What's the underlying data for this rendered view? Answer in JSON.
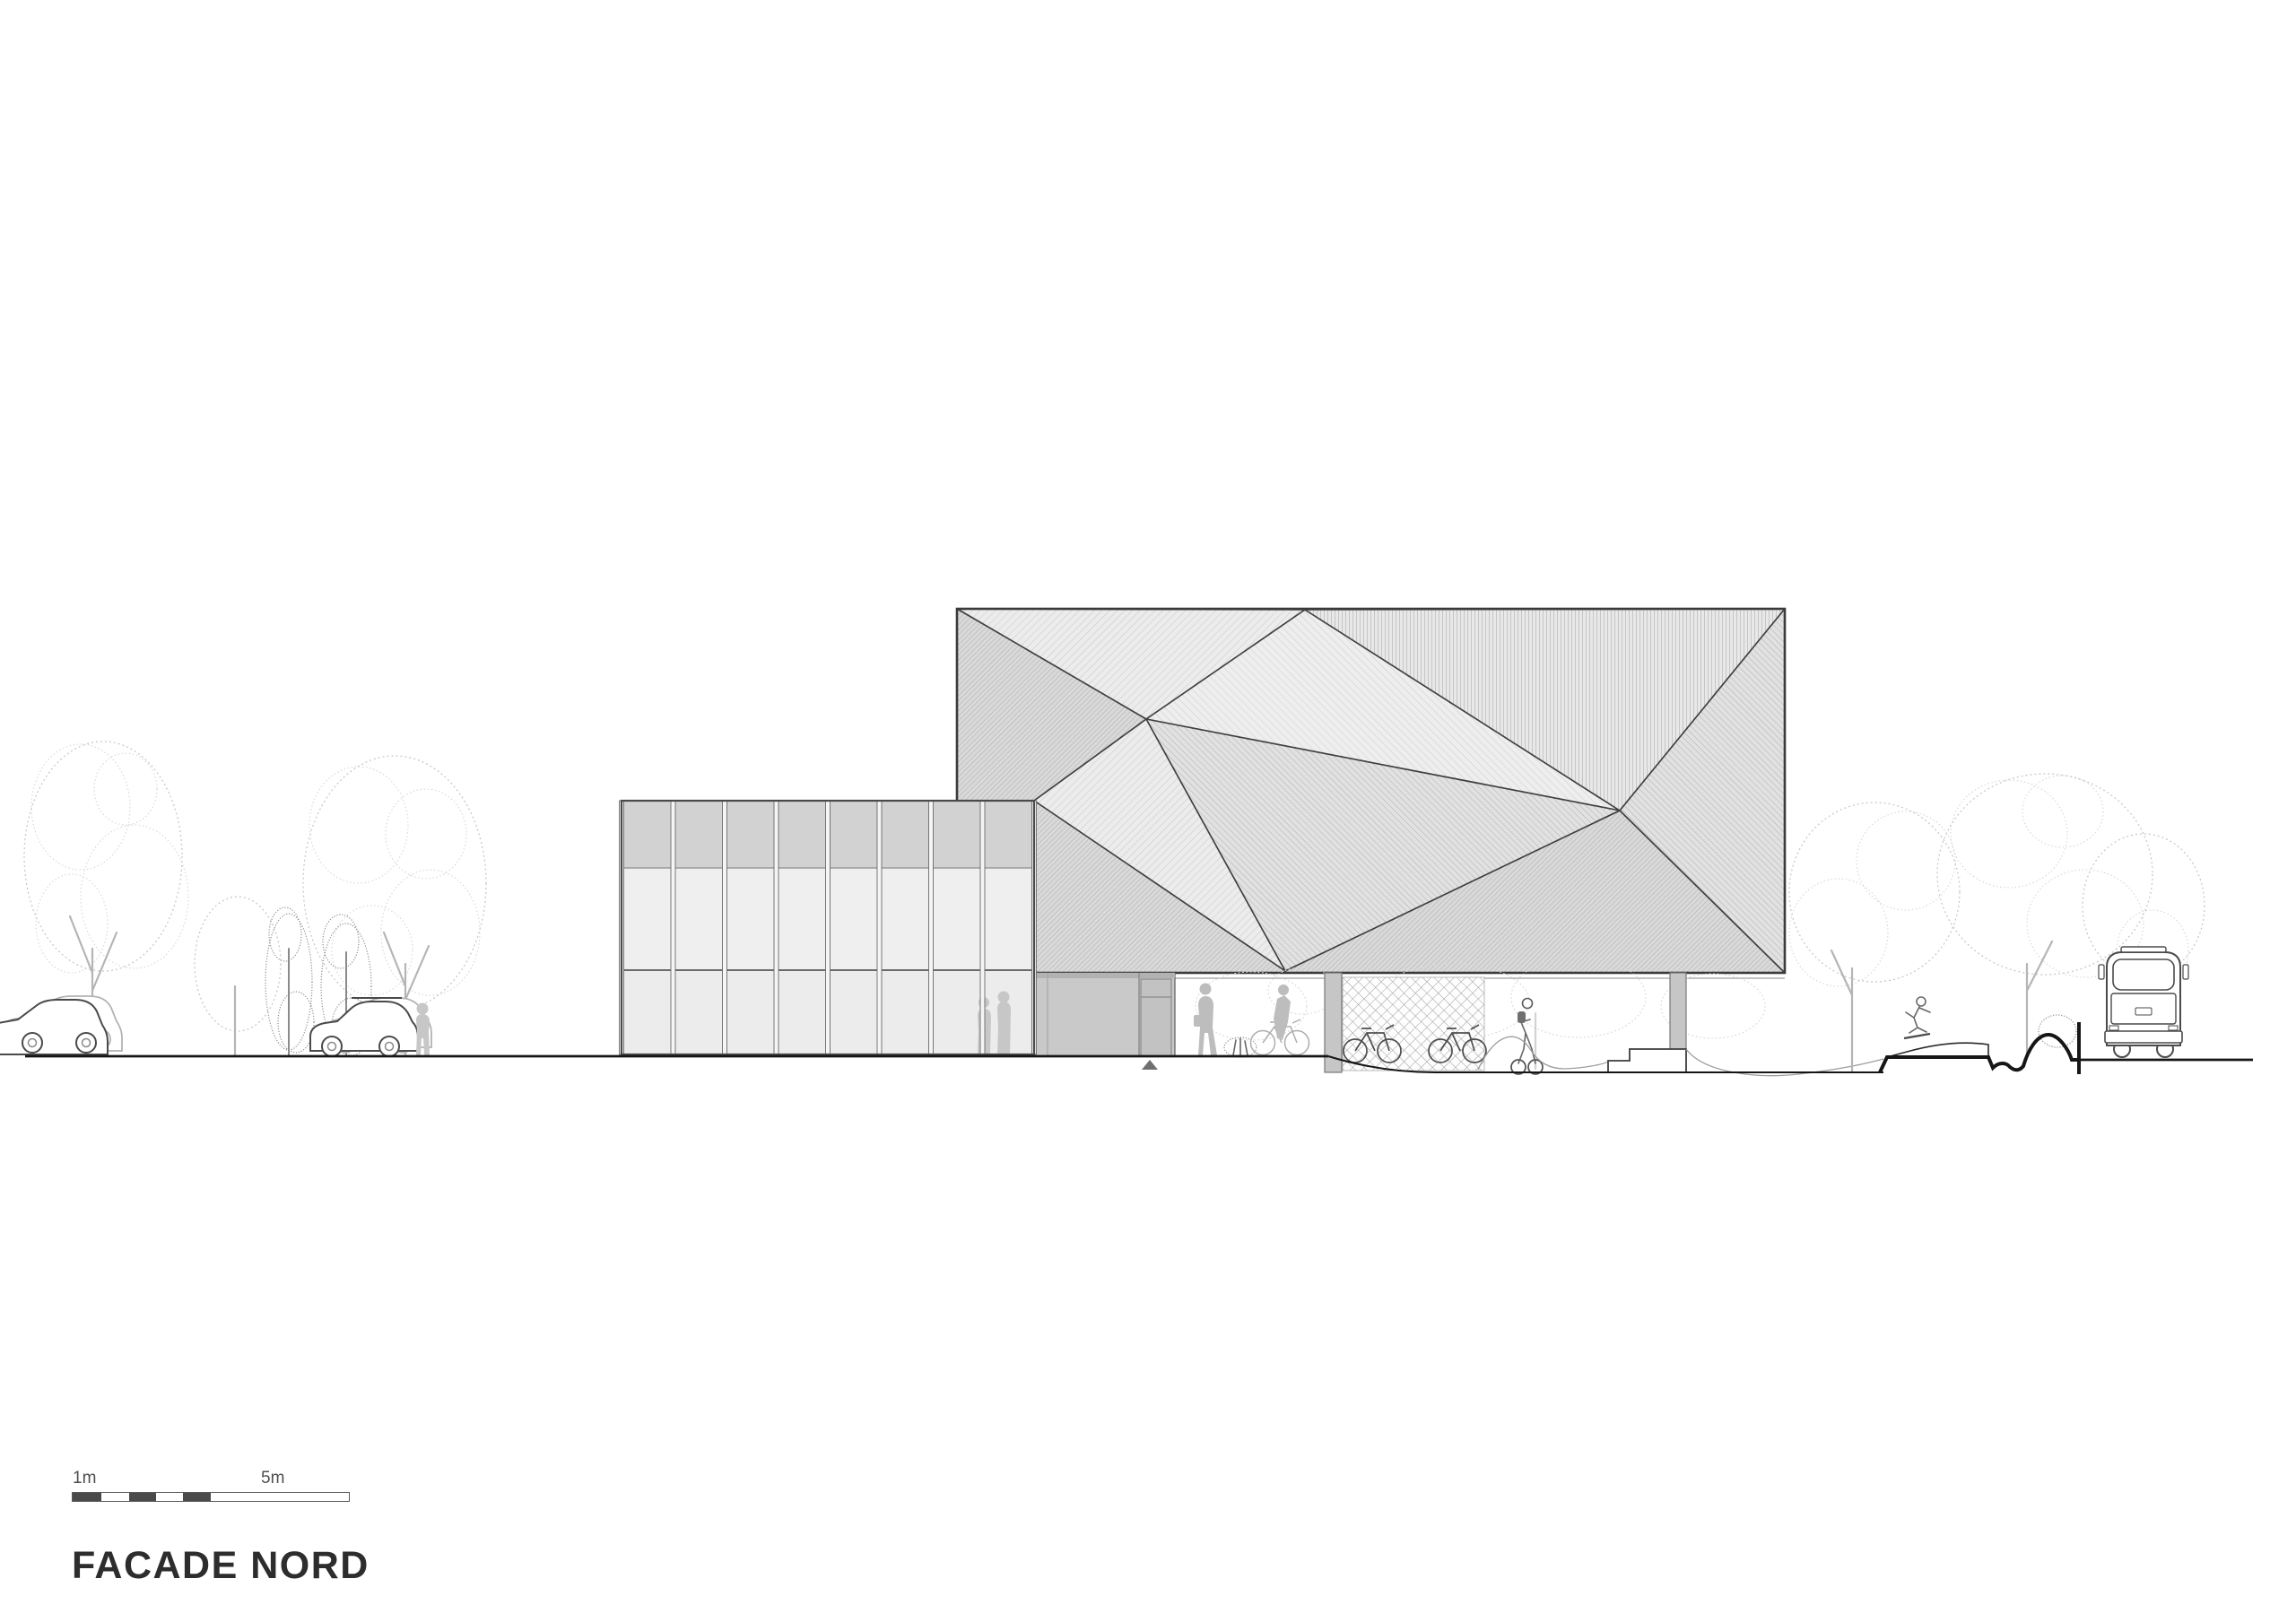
{
  "drawing": {
    "title": "FACADE NORD",
    "scale_bar": {
      "label_min": "1m",
      "label_max": "5m",
      "segments_m": [
        1,
        1,
        1,
        1,
        1,
        5
      ]
    }
  },
  "palette": {
    "ink": "#3a3a3a",
    "ground_line": "#161616",
    "scale_dark": "#4a4a4a",
    "facet_light": "#ececec",
    "facet_dark": "#d8d8d8",
    "glass": "#efefef",
    "spandrel": "#d2d2d2",
    "wall": "#c9c9c9",
    "foliage_light": "#c9c9c9",
    "foliage_dense": "#8f8f8f"
  },
  "legend": {
    "scene": "north elevation of faceted pavilion with glazed annex, street trees, cars, bus, bicycles, skatepark"
  }
}
